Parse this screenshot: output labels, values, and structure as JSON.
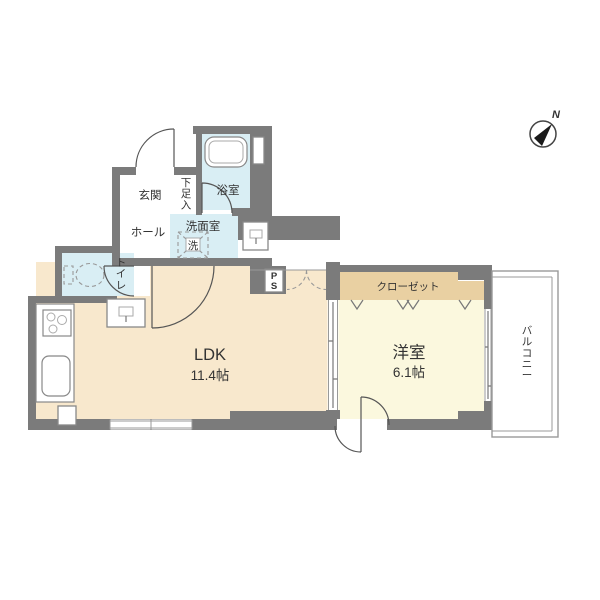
{
  "floorplan": {
    "compass": {
      "north_label": "N"
    },
    "rooms": {
      "genkan": {
        "label": "玄関"
      },
      "shoe_storage": {
        "label": "下足入"
      },
      "bathroom": {
        "label": "浴室"
      },
      "hall": {
        "label": "ホール"
      },
      "washroom": {
        "label": "洗面室"
      },
      "washer": {
        "label": "洗"
      },
      "toilet": {
        "label": "トイレ"
      },
      "pipe_space": {
        "label": "PS"
      },
      "ldk": {
        "label": "LDK",
        "area": "11.4帖"
      },
      "western_room": {
        "label": "洋室",
        "area": "6.1帖"
      },
      "closet": {
        "label": "クローゼット"
      },
      "balcony": {
        "label": "バルコニー"
      }
    },
    "colors": {
      "wall": "#7b7b7b",
      "ldk_floor": "#f8e8cd",
      "western_floor": "#fbf8de",
      "wet_floor": "#d9eef4",
      "closet_fill": "#e9d0a2",
      "line": "#999999",
      "text": "#333333"
    }
  }
}
